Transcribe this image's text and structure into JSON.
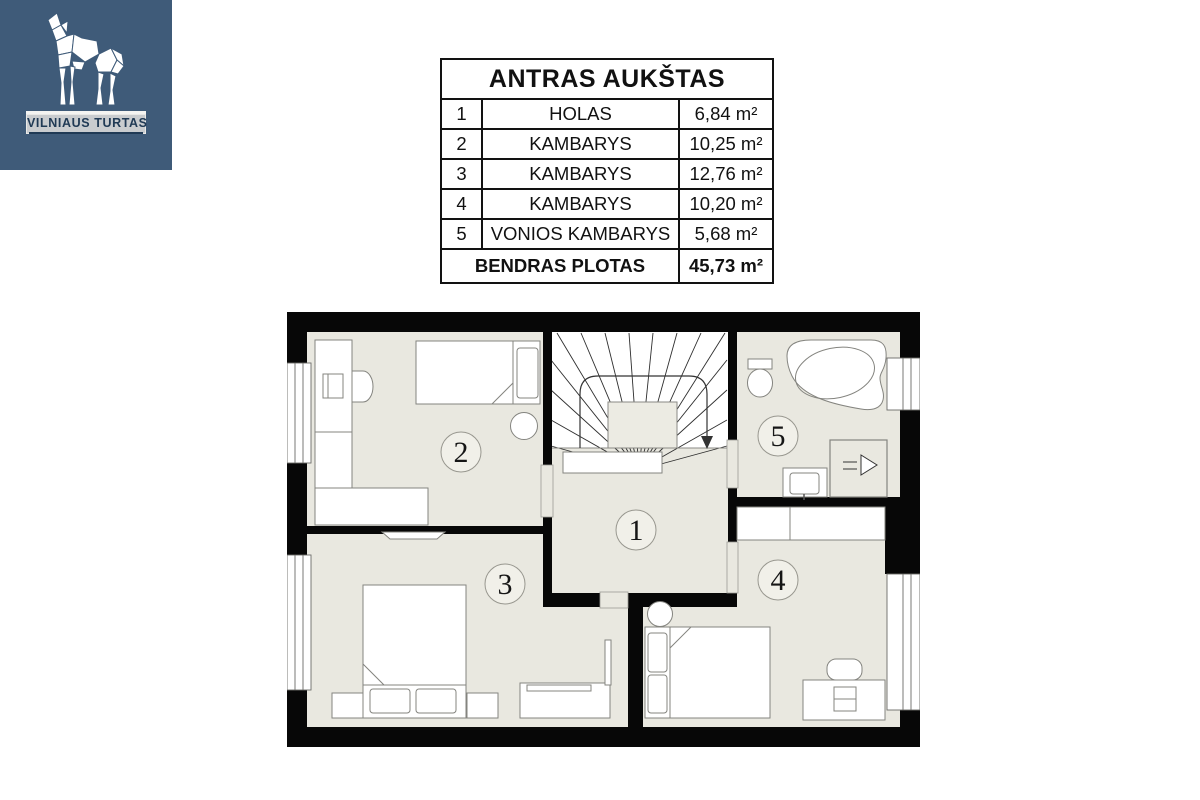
{
  "brand": {
    "name": "VILNIAUS TURTAS",
    "bg_color": "#3f5b79",
    "logo_icon": "origami-wolf-howling"
  },
  "table": {
    "title": "ANTRAS AUKŠTAS",
    "rows": [
      {
        "num": "1",
        "name": "HOLAS",
        "area": "6,84 m²"
      },
      {
        "num": "2",
        "name": "KAMBARYS",
        "area": "10,25 m²"
      },
      {
        "num": "3",
        "name": "KAMBARYS",
        "area": "12,76 m²"
      },
      {
        "num": "4",
        "name": "KAMBARYS",
        "area": "10,20 m²"
      },
      {
        "num": "5",
        "name": "VONIOS KAMBARYS",
        "area": "5,68 m²"
      }
    ],
    "total_label": "BENDRAS PLOTAS",
    "total_area": "45,73 m²"
  },
  "floorplan": {
    "rooms": [
      {
        "label": "1"
      },
      {
        "label": "2"
      },
      {
        "label": "3"
      },
      {
        "label": "4"
      },
      {
        "label": "5"
      }
    ],
    "colors": {
      "wall": "#070707",
      "floor": "#e9e8e0",
      "furniture": "#ffffff"
    }
  }
}
